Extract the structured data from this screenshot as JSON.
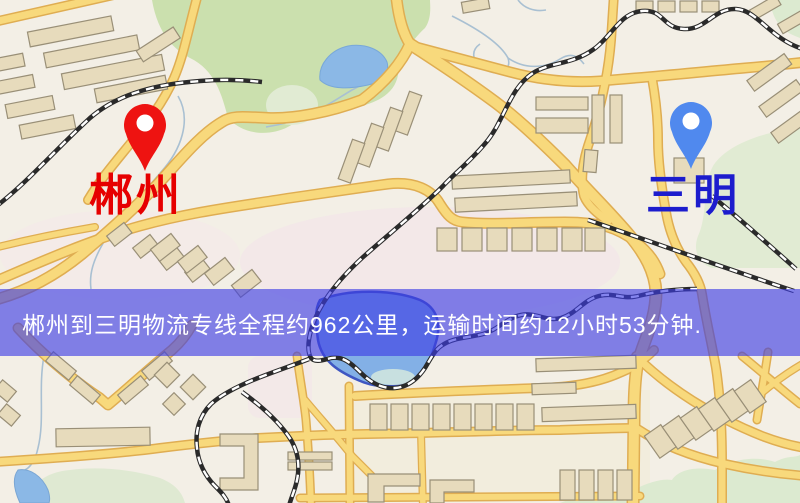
{
  "banner": {
    "text": "郴州到三明物流专线全程约962公里，运输时间约12小时53分钟.",
    "background_color": "rgba(60,60,228,0.63)",
    "text_color": "#ffffff",
    "route": {
      "origin": "郴州",
      "destination": "三明",
      "distance": "约962公里",
      "duration": "约12小时53分钟"
    }
  },
  "markers": {
    "origin": {
      "label": "郴州",
      "pin_color": "#ee1311",
      "label_color": "#e60000"
    },
    "destination": {
      "label": "三明",
      "pin_color": "#5089ee",
      "label_color": "#1c1ccd"
    }
  },
  "map": {
    "style": "street-map-tile",
    "palette": {
      "background": "#f3efe6",
      "road_fill": "#f8d97c",
      "road_casing": "#dfad52",
      "water": "#83b0e6",
      "park_green": "#cbe0ae",
      "pale_green": "#e1ebd3",
      "building": "#e7dbbc",
      "railway": "#2a2a2a"
    }
  }
}
